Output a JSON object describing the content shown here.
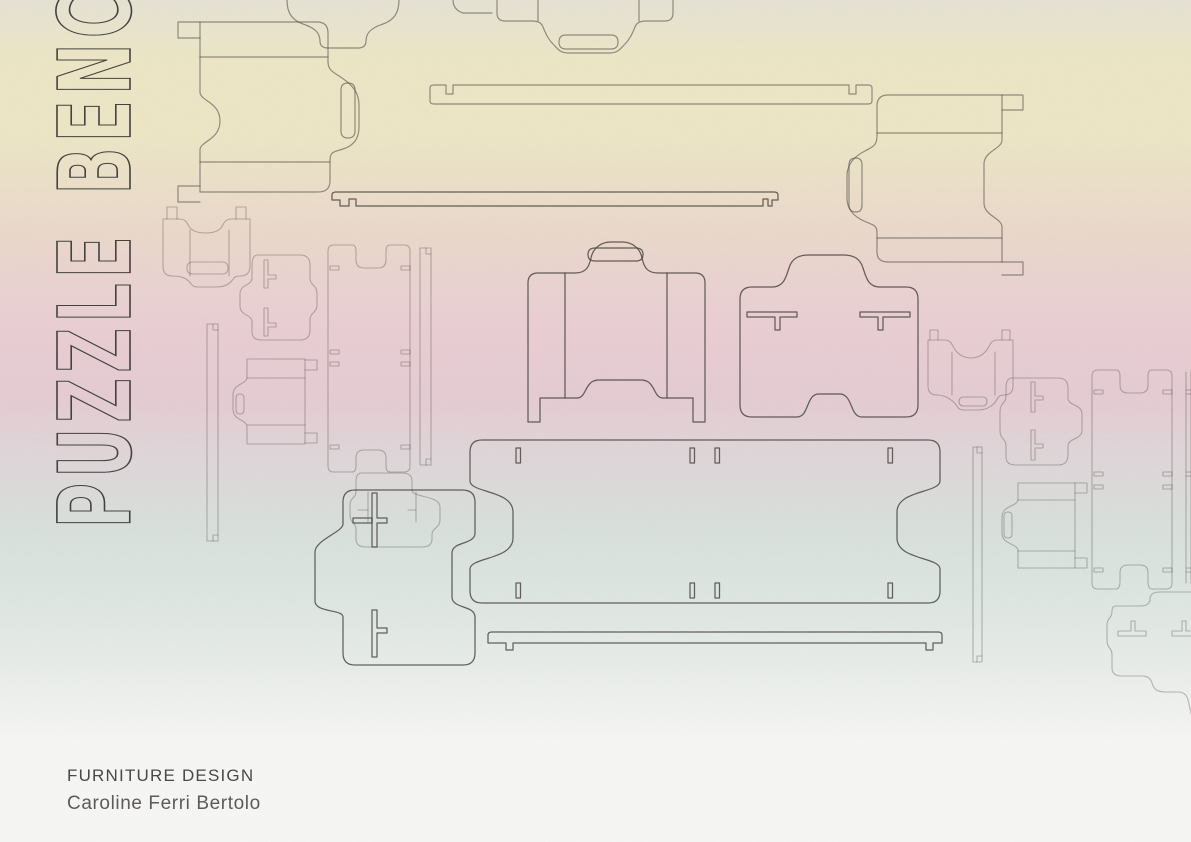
{
  "poster": {
    "title": "PUZZLE BENCH",
    "category": "FURNITURE DESIGN",
    "author": "Caroline Ferri Bertolo"
  },
  "colors": {
    "bg_top_gray": "#e6e2d4",
    "bg_cream": "#ece6c6",
    "bg_sand": "#ead9cb",
    "bg_blush": "#e9cfd3",
    "bg_pink": "#e5ccd3",
    "bg_fog": "#ded7d9",
    "bg_teal": "#d8e1dc",
    "bg_sage": "#dfe7e2",
    "bg_mist": "#e8ece9",
    "bg_white": "#f6f6f4",
    "outline": "#45423e",
    "text": "#3c3a37"
  }
}
